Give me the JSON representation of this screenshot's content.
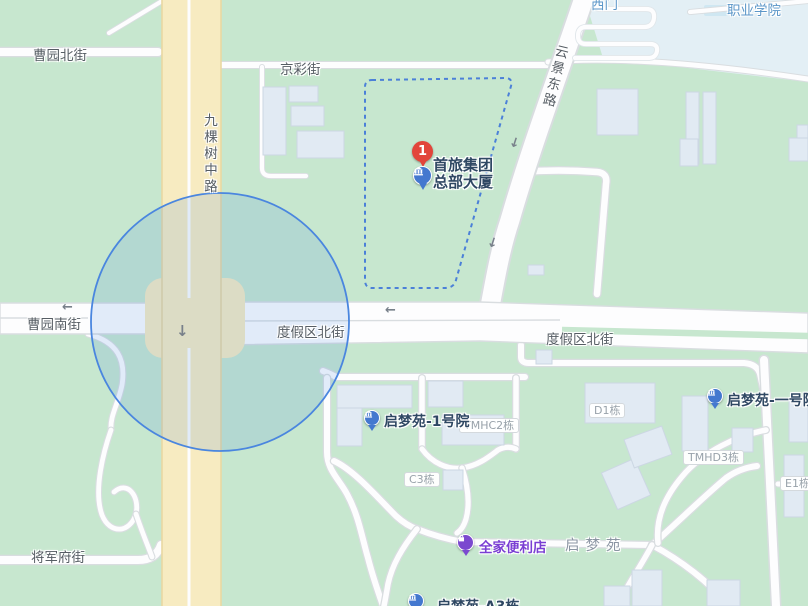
{
  "colors": {
    "bg_green": "#c7e7cf",
    "campus": "#e3eff5",
    "pool": "#cfe7f2",
    "bldg": "#e1eaf3",
    "bldg_stroke": "#ccd7e3",
    "road_casing": "#d9dde0",
    "road_white": "#fdfdfe",
    "road_yellow": "#f7ebc1",
    "yellow_casing": "#e9d8a2",
    "circle_stroke": "#4a86df",
    "circle_fill": "rgba(66,133,224,0.15)",
    "dash_blue": "#4b80d8",
    "poi_blue": "#4478cf",
    "poi_purple": "#7b49cf",
    "marker_red": "#e2453b",
    "label_dark": "#2f4863",
    "street_gray": "#565d64",
    "badge_gray": "#98a2aa",
    "badge_border": "#d4d9dd",
    "blue_text": "#5b96c8",
    "area_gray": "#8b95a3",
    "fam_purple": "#7a3fd3"
  },
  "streets": {
    "caoyuan_north": "曹园北街",
    "jingcai": "京彩街",
    "jiukeshu_middle": "九棵树中路",
    "yunjing_east": "云景东路",
    "caoyuan_south": "曹园南街",
    "dujiaqu_north_west": "度假区北街",
    "dujiaqu_north_east": "度假区北街",
    "jiangjunfu": "将军府街"
  },
  "places": {
    "west_gate": "西门",
    "vocational_college": "职业学院",
    "qimengyuan_area": "启梦苑"
  },
  "marker": {
    "badge": "1",
    "line1": "首旅集团",
    "line2": "总部大厦"
  },
  "pois": {
    "qimengyuan_1": "启梦苑-1号院",
    "qimengyuan_yihao": "启梦苑-一号院",
    "familymart": "全家便利店",
    "qimengyuan_a3": "启梦苑-A3栋"
  },
  "buildings": {
    "tmhc2": "TMHC2栋",
    "d1": "D1栋",
    "tmhd3": "TMHD3栋",
    "c3": "C3栋",
    "e1": "E1栋"
  },
  "arrows": {
    "left": "←",
    "down": "↓"
  }
}
